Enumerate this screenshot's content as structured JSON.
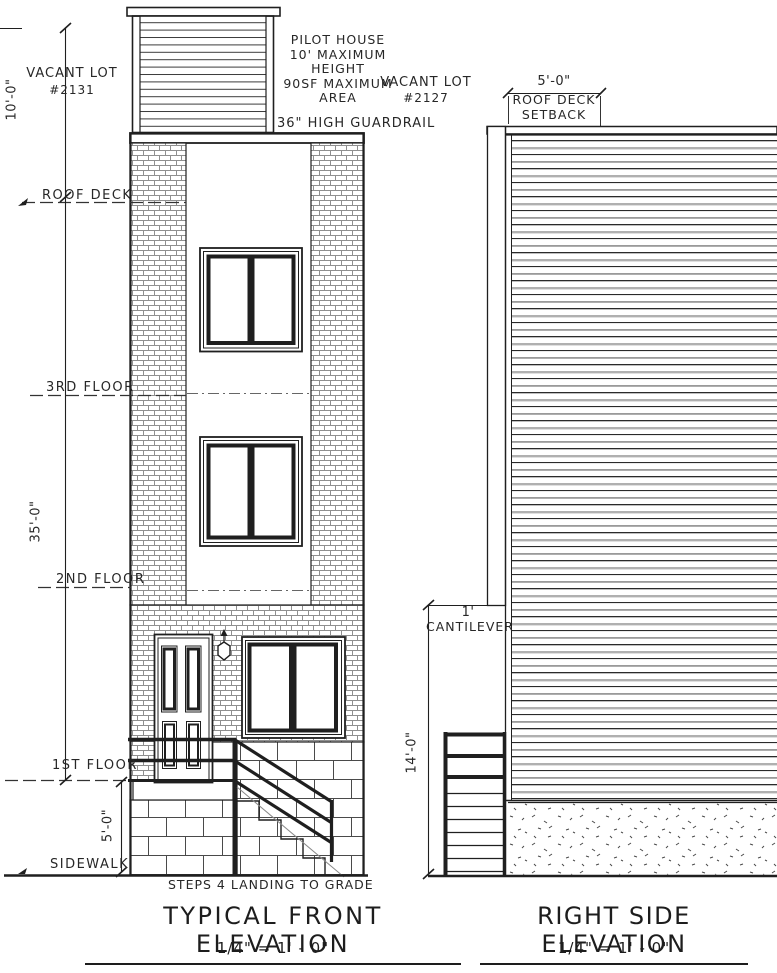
{
  "front": {
    "title": "TYPICAL FRONT ELEVATION",
    "scale": "1/4\" = 1' - 0\"",
    "vacant_lot_left": {
      "name": "VACANT LOT",
      "number": "#2131"
    },
    "vacant_lot_right": {
      "name": "VACANT LOT",
      "number": "#2127"
    },
    "pilot_house_note": {
      "line1": "PILOT HOUSE",
      "line2": "10' MAXIMUM HEIGHT",
      "line3": "90SF MAXIMUM",
      "line4": "AREA"
    },
    "guardrail_note": "36\" HIGH GUARDRAIL",
    "levels": {
      "roof_deck": "ROOF DECK",
      "third_floor": "3RD FLOOR",
      "second_floor": "2ND FLOOR",
      "first_floor": "1ST FLOOR",
      "sidewalk": "SIDEWALK"
    },
    "dimensions": {
      "pilot_house_height": "10'-0\"",
      "building_height": "35'-0\"",
      "first_floor_to_grade": "5'-0\""
    },
    "steps_note": "STEPS 4 LANDING TO GRADE"
  },
  "side": {
    "title": "RIGHT SIDE ELEVATION",
    "scale": "1/4\" = 1' - 0\"",
    "setback": {
      "dimension": "5'-0\"",
      "label_line1": "ROOF DECK",
      "label_line2": "SETBACK"
    },
    "cantilever": {
      "dimension": "1'",
      "label": "CANTILEVER"
    },
    "dimensions": {
      "first_floor_height": "14'-0\""
    }
  },
  "colors": {
    "ink": "#1f1f1f",
    "soft_line": "#8a8a8a",
    "paper": "#ffffff"
  }
}
